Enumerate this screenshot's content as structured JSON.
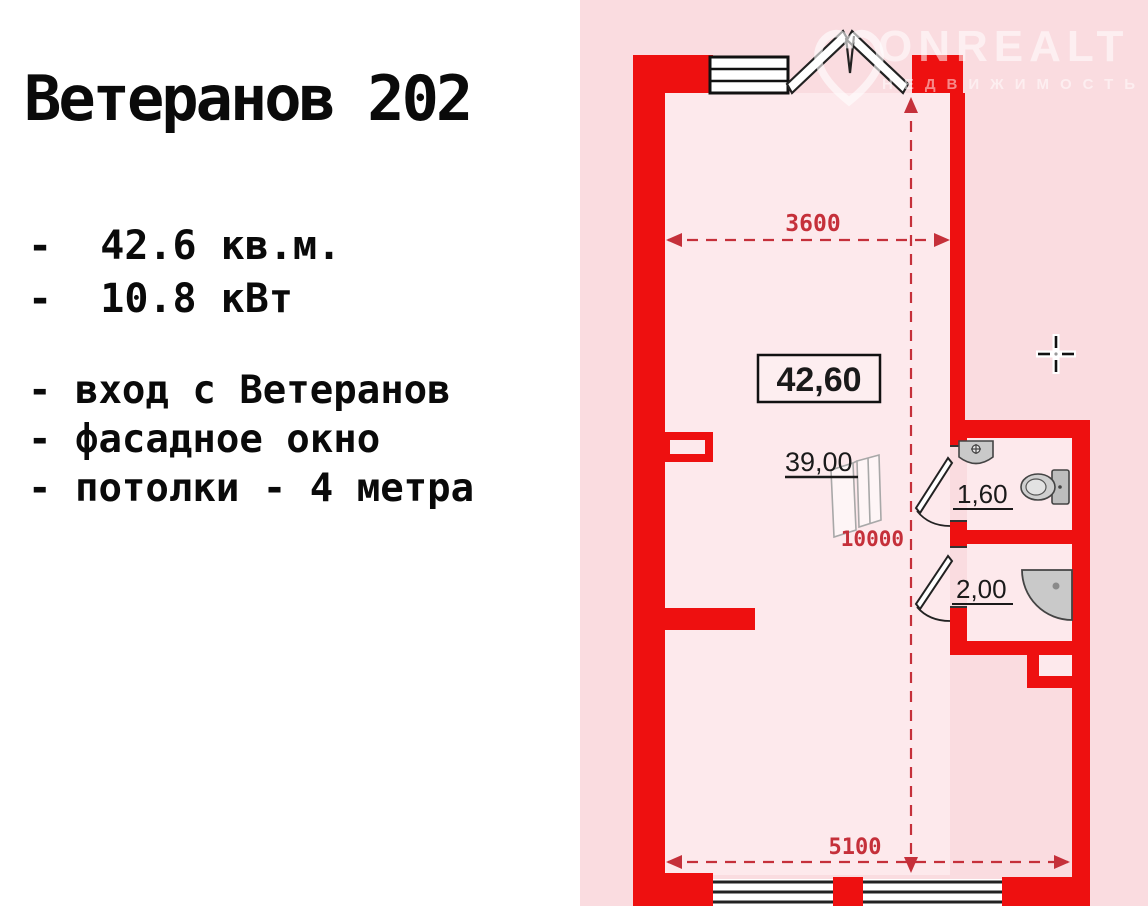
{
  "left_panel": {
    "title": "Ветеранов 202",
    "specs": [
      "-  42.6 кв.м.",
      "-  10.8 кВт"
    ],
    "features": [
      "- вход с Ветеранов",
      "- фасадное окно",
      "- потолки - 4 метра"
    ]
  },
  "floor_plan": {
    "total_area_label": "42,60",
    "wardrobe_label": "39,00",
    "wc_area_label": "1,60",
    "shower_area_label": "2,00",
    "dim_top_mm": "3600",
    "dim_height_mm": "10000",
    "dim_bottom_mm": "5100"
  },
  "watermark": {
    "brand": "ONREALT",
    "subtitle": "НЕДВИЖИМОСТЬ"
  },
  "colors": {
    "wall_red": "#ee1010",
    "dimension_red": "#c5303a",
    "panel_pink": "#fadce0",
    "interior_pink": "#fde9ec",
    "text_black": "#0a0a0a"
  }
}
